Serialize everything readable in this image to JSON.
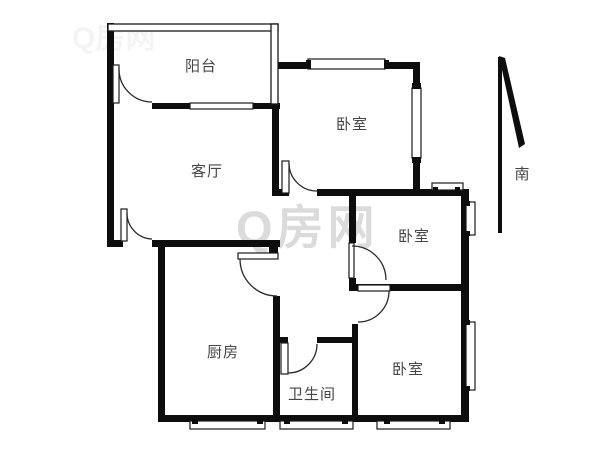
{
  "canvas": {
    "width": 600,
    "height": 450,
    "background": "#ffffff"
  },
  "floor_plan": {
    "rooms": [
      {
        "id": "balcony",
        "label": "阳台"
      },
      {
        "id": "living-room",
        "label": "客厅"
      },
      {
        "id": "bedroom-top",
        "label": "卧室"
      },
      {
        "id": "bedroom-middle",
        "label": "卧室"
      },
      {
        "id": "bedroom-bottom",
        "label": "卧室"
      },
      {
        "id": "kitchen",
        "label": "厨房"
      },
      {
        "id": "bathroom",
        "label": "卫生间"
      }
    ],
    "compass": {
      "label": "南"
    },
    "watermark": {
      "text": "Q房网"
    },
    "colors": {
      "wall": "#0d0d0d",
      "label": "#464646",
      "watermark": "#d8d8d8",
      "watermark_faint": "#ececec"
    }
  }
}
